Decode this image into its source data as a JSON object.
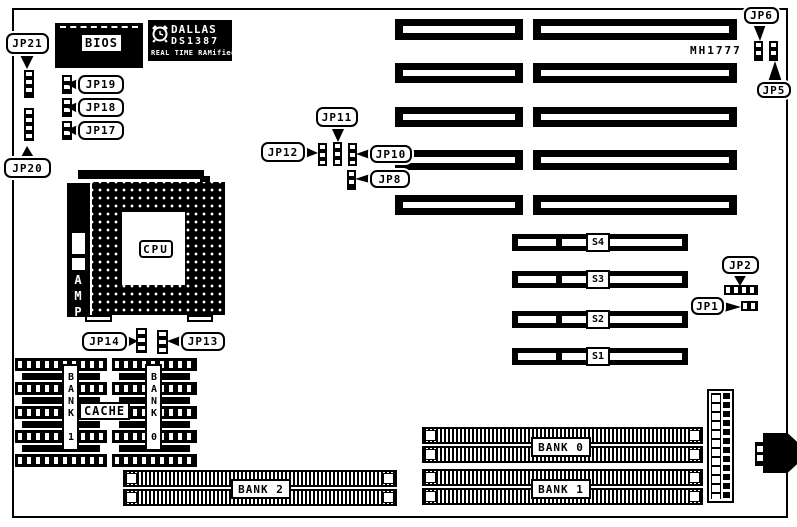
{
  "diagram": {
    "part_number": "MH1777",
    "bios_label": "BIOS",
    "rtc_chip": {
      "brand": "DALLAS",
      "model": "DS1387",
      "line3": "REAL TIME RAMified"
    },
    "cpu_label": "CPU",
    "socket_brand": "AMP",
    "cache_label": "CACHE",
    "sram_banks": {
      "bank1": "BANK 1",
      "bank0": "BANK 0"
    },
    "simm_banks": {
      "bank0": "BANK 0",
      "bank1": "BANK 1",
      "bank2": "BANK 2"
    },
    "s_slots": {
      "s4": "S4",
      "s3": "S3",
      "s2": "S2",
      "s1": "S1"
    },
    "jumpers": {
      "jp1": "JP1",
      "jp2": "JP2",
      "jp5": "JP5",
      "jp6": "JP6",
      "jp8": "JP8",
      "jp10": "JP10",
      "jp11": "JP11",
      "jp12": "JP12",
      "jp13": "JP13",
      "jp14": "JP14",
      "jp17": "JP17",
      "jp18": "JP18",
      "jp19": "JP19",
      "jp20": "JP20",
      "jp21": "JP21"
    }
  }
}
